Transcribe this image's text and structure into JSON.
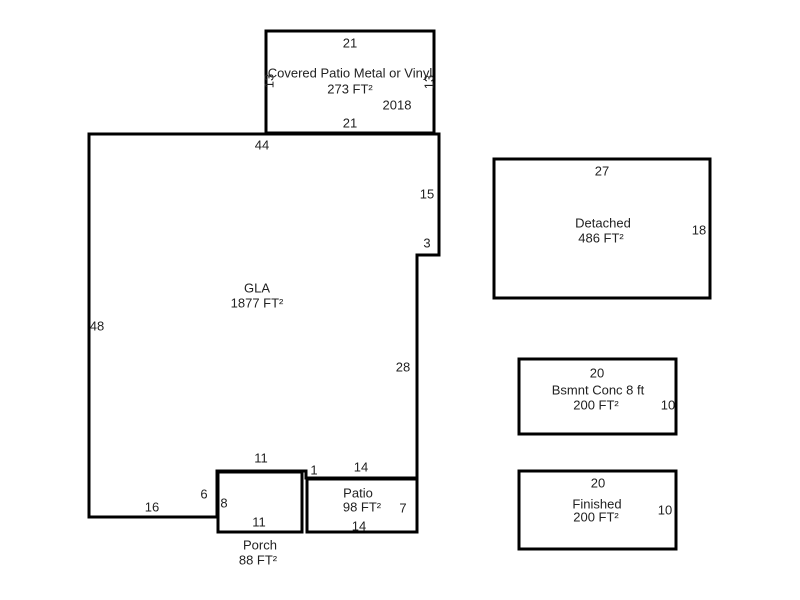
{
  "colors": {
    "line": "#000000",
    "text": "#222222",
    "background": "#ffffff"
  },
  "areas": {
    "covered_patio": {
      "name": "Covered Patio Metal or Vinyl",
      "area": "273 FT²",
      "year": "2018",
      "dim_top": "21",
      "dim_bottom": "21",
      "dim_left": "13",
      "dim_right": "13"
    },
    "gla": {
      "name": "GLA",
      "area": "1877 FT²",
      "dim_top": "44",
      "dim_left": "48",
      "dim_right_upper": "15",
      "dim_step": "3",
      "dim_right_lower": "28",
      "dim_bottom_left": "16",
      "dim_porch_step": "6",
      "dim_porch_top": "11",
      "dim_patio_step": "1",
      "dim_patio_top": "14"
    },
    "porch": {
      "name": "Porch",
      "area": "88 FT²",
      "dim_left": "8",
      "dim_bottom": "11"
    },
    "patio": {
      "name": "Patio",
      "area": "98 FT²",
      "dim_right": "7",
      "dim_bottom": "14"
    },
    "detached": {
      "name": "Detached",
      "area": "486 FT²",
      "dim_top": "27",
      "dim_right": "18"
    },
    "basement": {
      "name": "Bsmnt Conc 8 ft",
      "area": "200 FT²",
      "dim_top": "20",
      "dim_right": "10"
    },
    "finished": {
      "name": "Finished",
      "area": "200 FT²",
      "dim_top": "20",
      "dim_right": "10"
    }
  }
}
